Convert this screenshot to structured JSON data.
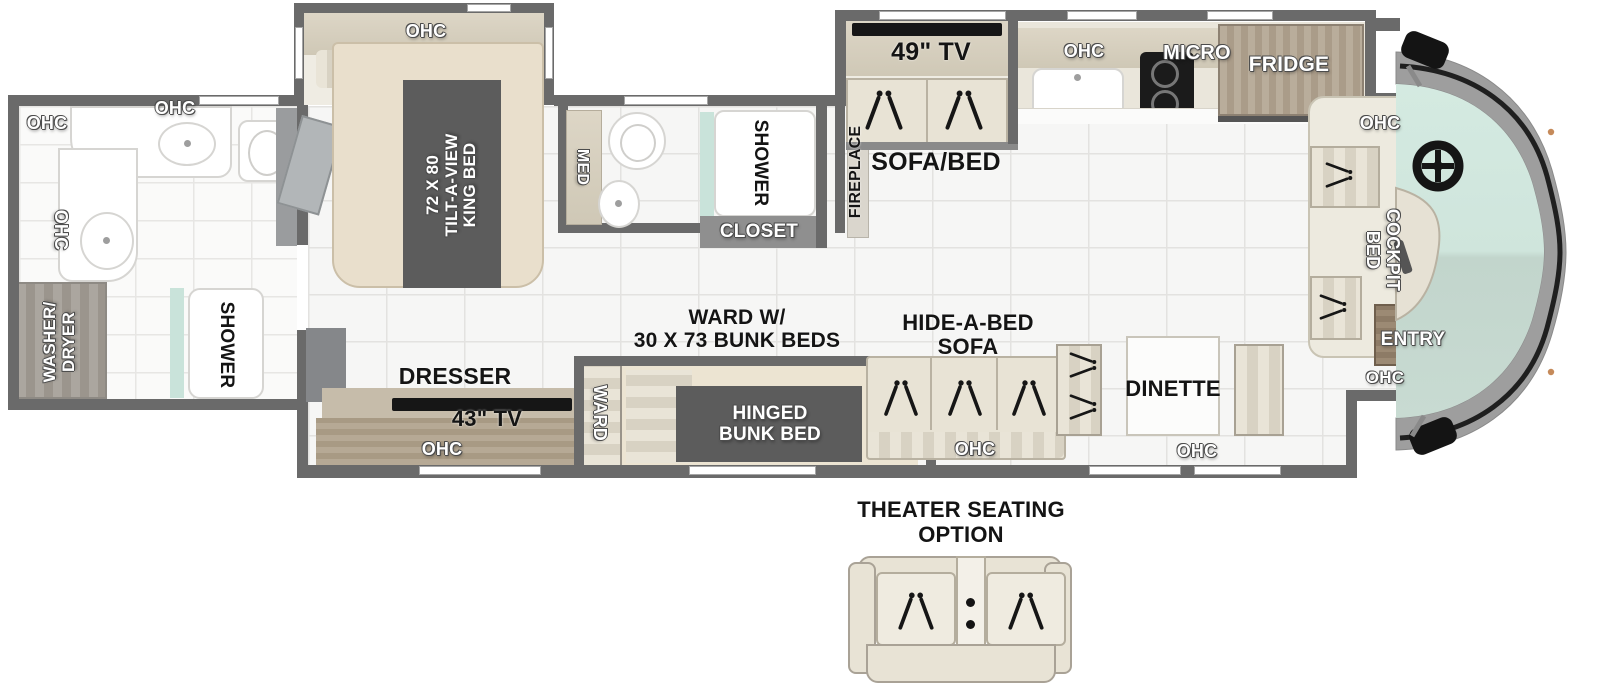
{
  "colors": {
    "wall": "#6a6a6a",
    "floor": "#f6f6f5",
    "grout": "#e3e2e0",
    "beige": "#e8e3d5",
    "cabinet": "#ddd6c6",
    "dark_band": "#5c5c5c",
    "glass": "#c9e3da",
    "cap": "#9e9e9e",
    "tv_black": "#161616"
  },
  "floorplan": {
    "rear_bath": {
      "ohc_top_left": "OHC",
      "ohc_top": "OHC",
      "ohc_side": "OHC",
      "washer_dryer": "WASHER/\nDRYER",
      "shower": "SHOWER"
    },
    "bedroom": {
      "slide_ohc": "OHC",
      "king_bed": "72 X 80\nTILT-A-VIEW\nKING BED",
      "dresser": "DRESSER",
      "tv": "43\" TV",
      "ohc": "OHC",
      "ward": "WARD"
    },
    "mid_bath": {
      "med": "MED",
      "shower": "SHOWER",
      "closet": "CLOSET"
    },
    "living": {
      "fireplace": "FIREPLACE",
      "tv": "49\" TV",
      "sofa_bed": "SOFA/BED",
      "bunk_note": "WARD W/\n30 X 73 BUNK BEDS",
      "hinged_bunk": "HINGED\nBUNK BED",
      "hide_a_bed": "HIDE-A-BED\nSOFA",
      "sofa_ohc": "OHC",
      "dinette": "DINETTE",
      "dinette_ohc": "OHC"
    },
    "kitchen": {
      "ohc": "OHC",
      "micro": "MICRO",
      "fridge": "FRIDGE"
    },
    "cockpit": {
      "ohc": "OHC",
      "bed": "COCKPIT\nBED",
      "entry": "ENTRY",
      "entry_ohc": "OHC"
    },
    "options": {
      "theater": "THEATER SEATING\nOPTION"
    }
  }
}
